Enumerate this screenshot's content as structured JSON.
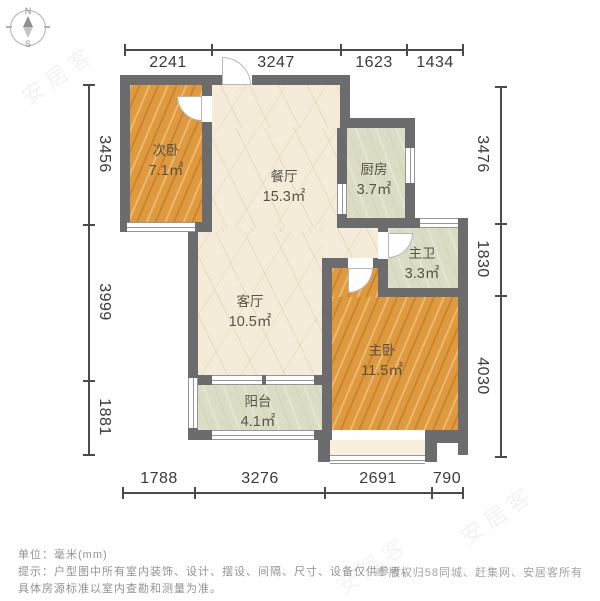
{
  "compass": {
    "north": "N",
    "south": "S"
  },
  "dimensions": {
    "top": [
      "2241",
      "3247",
      "1623",
      "1434"
    ],
    "bottom": [
      "1788",
      "3276",
      "2691",
      "790"
    ],
    "left": [
      "3456",
      "3999",
      "1881"
    ],
    "right": [
      "3476",
      "1830",
      "4030"
    ]
  },
  "rooms": [
    {
      "name": "次卧",
      "area": "7.1㎡"
    },
    {
      "name": "餐厅",
      "area": "15.3㎡"
    },
    {
      "name": "厨房",
      "area": "3.7㎡"
    },
    {
      "name": "主卫",
      "area": "3.3㎡"
    },
    {
      "name": "客厅",
      "area": "10.5㎡"
    },
    {
      "name": "主卧",
      "area": "11.5㎡"
    },
    {
      "name": "阳台",
      "area": "4.1㎡"
    }
  ],
  "footer": {
    "unit_line": "单位：毫米(mm)",
    "note_line1": "提示：户型图中所有室内装饰、设计、摆设、间隔、尺寸、设备仅供参考，",
    "note_line2": "具体房源标准以室内查勘和测量为准。",
    "copyright": "© 版权归58同城、赶集网、安居客所有"
  },
  "watermark": {
    "text": "安居客"
  },
  "colors": {
    "wall": "#6c6c6e",
    "wood_floor": "#df9a3f",
    "marble_floor": "#f4ecd8",
    "green_floor": "#dadcc4",
    "dimension_text": "#3a3a3c",
    "footer_text": "#929292"
  }
}
